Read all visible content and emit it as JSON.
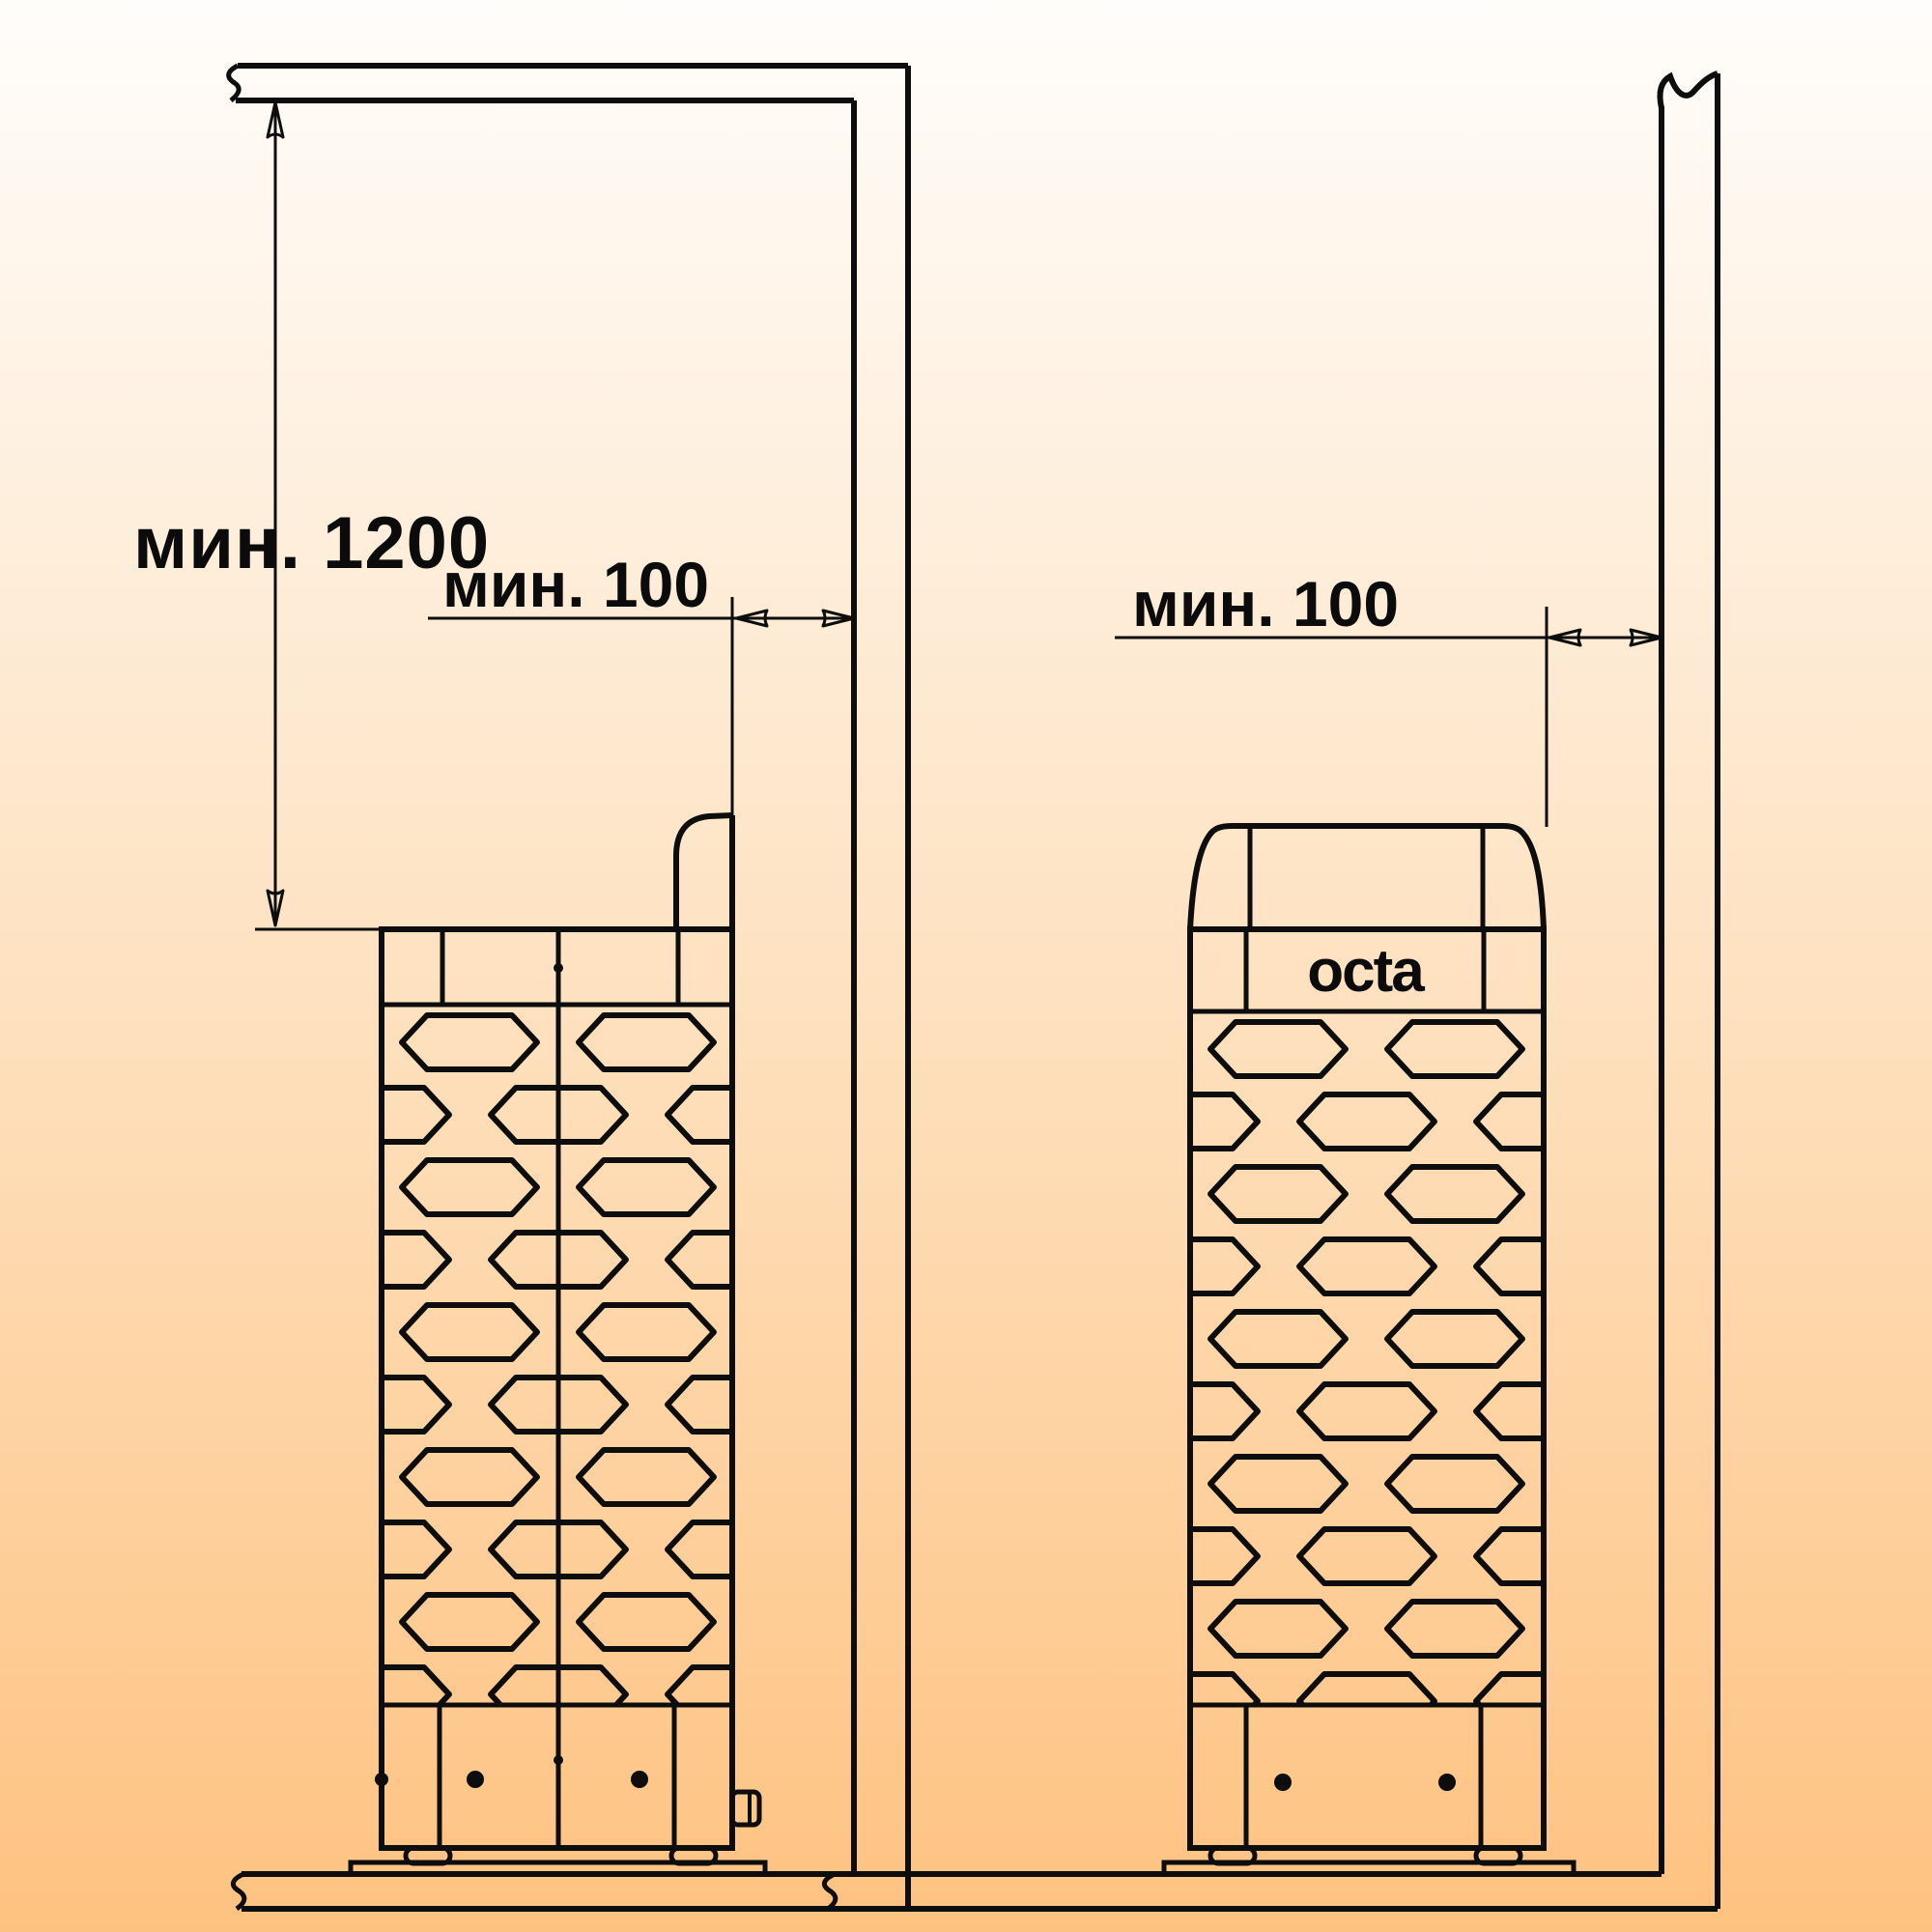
{
  "colors": {
    "background_top": "#FFFDFB",
    "background_middle": "#FEE1BF",
    "background_bottom": "#FEC280",
    "line": "#0D0D0D",
    "text": "#0B0B0B"
  },
  "left_view": {
    "height_clearance_label": "мин. 1200",
    "wall_clearance_label": "мин. 100"
  },
  "right_view": {
    "wall_clearance_label": "мин. 100",
    "heater_logo": "octa"
  }
}
